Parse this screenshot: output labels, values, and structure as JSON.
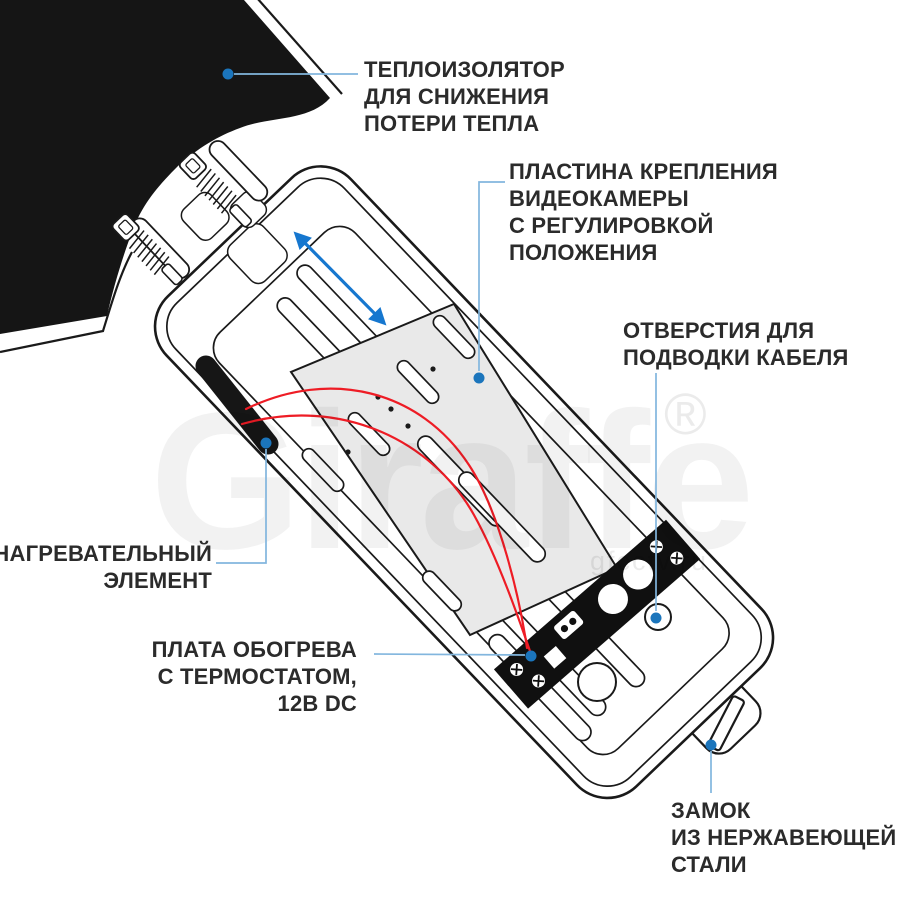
{
  "labels": {
    "insulator": "ТЕПЛОИЗОЛЯТОР\nДЛЯ СНИЖЕНИЯ\nПОТЕРИ ТЕПЛА",
    "plate": "ПЛАСТИНА КРЕПЛЕНИЯ\nВИДЕОКАМЕРЫ\nС РЕГУЛИРОВКОЙ\nПОЛОЖЕНИЯ",
    "cable_holes": "ОТВЕРСТИЯ ДЛЯ\nПОДВОДКИ КАБЕЛЯ",
    "heating_element": "НАГРЕВАТЕЛЬНЫЙ\nЭЛЕМЕНТ",
    "heater_board": "ПЛАТА ОБОГРЕВА\nС ТЕРМОСТАТОМ,\n12В DC",
    "lock": "ЗАМОК\nИЗ НЕРЖАВЕЮЩЕЙ\nСТАЛИ"
  },
  "watermark": {
    "brand": "Giraffe",
    "registered": "®",
    "site": "gfcctv.ru"
  },
  "colors": {
    "callout_dot": "#1b75bc",
    "leader_line": "#82b6de",
    "arrow": "#1677cf",
    "wire": "#ee1c25",
    "ink": "#1a1a1a",
    "insulator_fill": "#151515",
    "plate_fill": "#e9e9e9",
    "board_fill": "#101010",
    "label_text": "#2b2b2b"
  }
}
